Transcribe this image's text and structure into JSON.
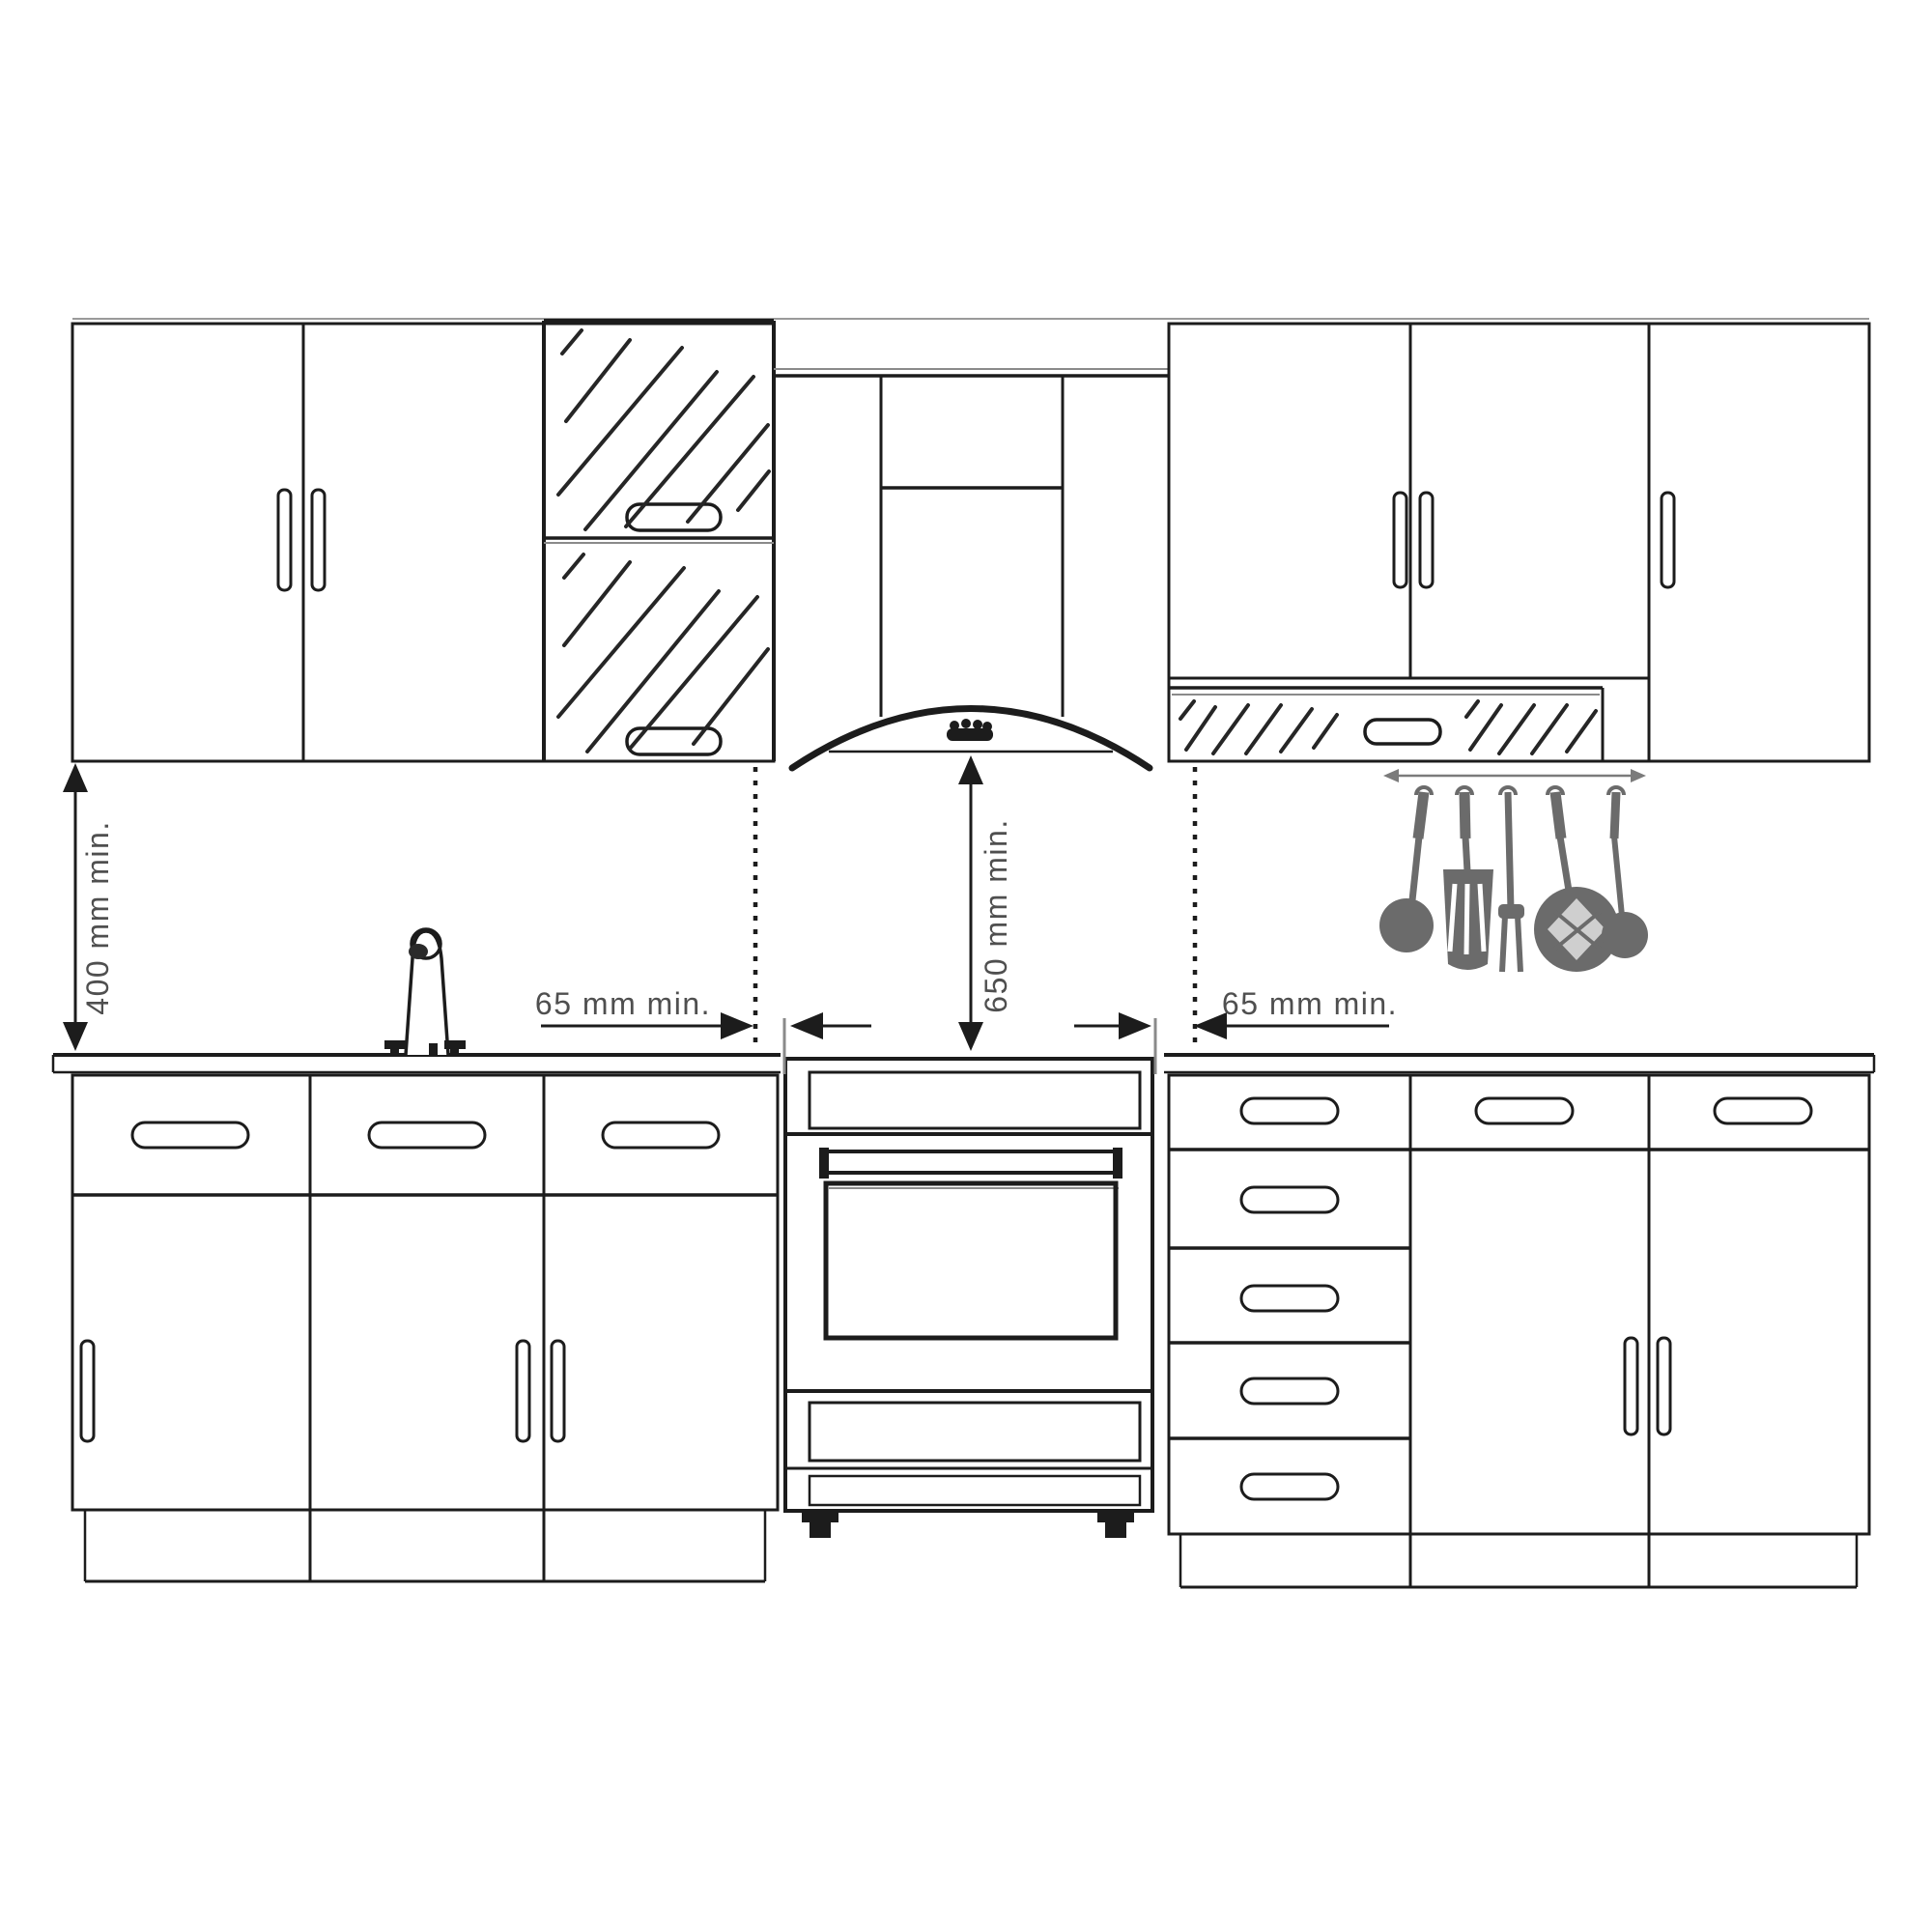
{
  "diagram": {
    "labels": {
      "left_clearance_vertical": "400 mm min.",
      "hood_clearance_vertical": "650 mm min.",
      "left_clearance_horizontal": "65 mm min.",
      "right_clearance_horizontal": "65 mm min."
    },
    "colors": {
      "line": "#1c1c1c",
      "secondary_line": "#8a8a8a",
      "dimension_text": "#4f4f4f",
      "utensil": "#6b6b6b",
      "background": "#ffffff"
    }
  }
}
